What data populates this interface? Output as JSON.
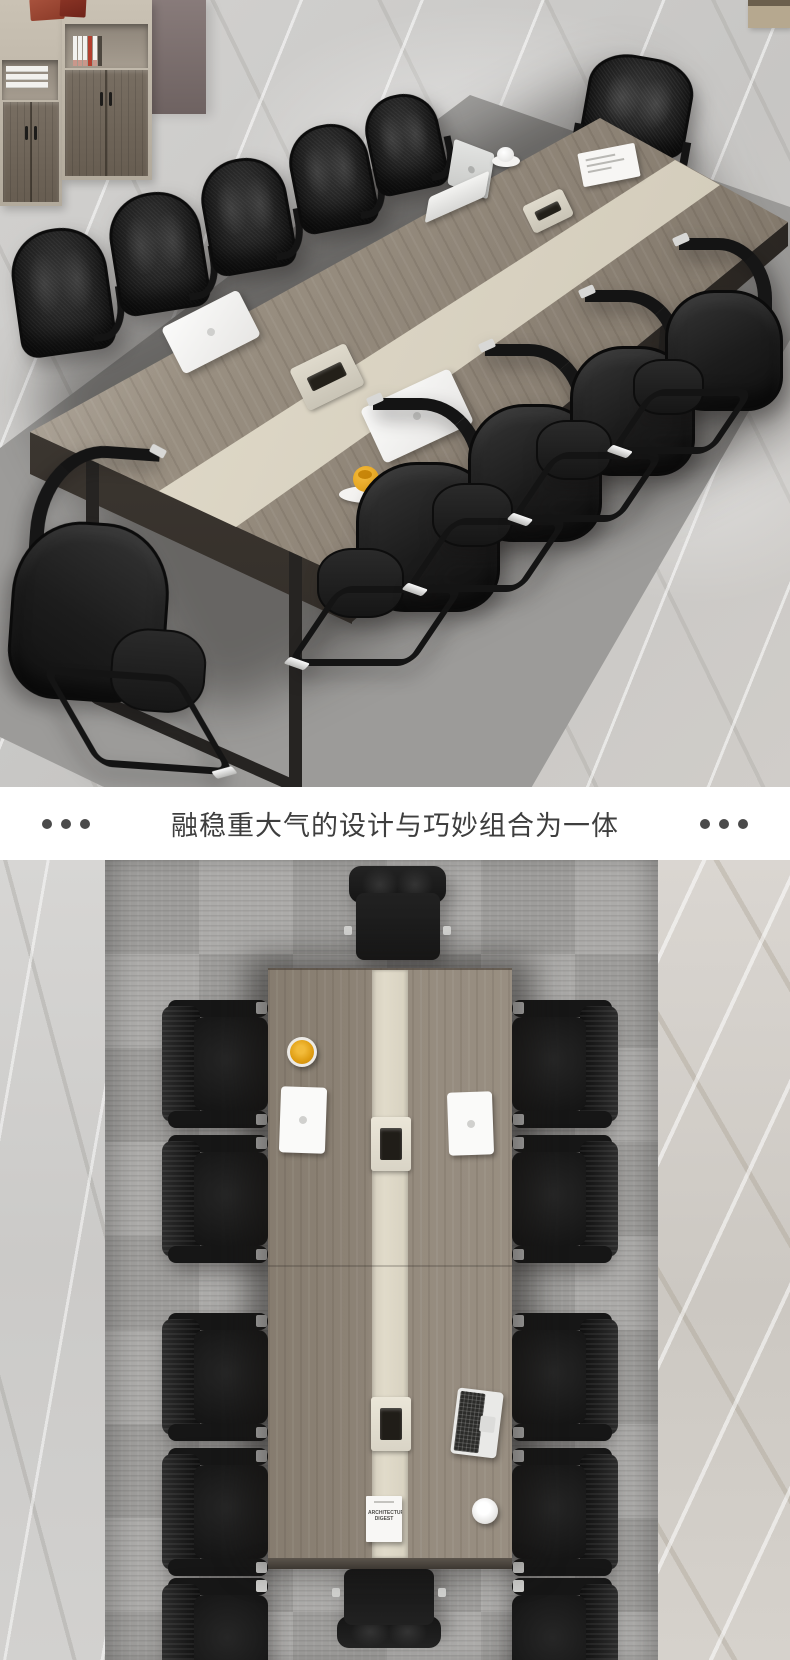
{
  "banner": {
    "title": "融稳重大气的设计与巧妙组合为一体",
    "left_dots": [
      "dot",
      "dot",
      "dot"
    ],
    "right_dots": [
      "dot",
      "dot",
      "dot"
    ],
    "text_color": "#3e3e3e",
    "dot_color": "#4a4a4a",
    "background": "#ffffff"
  },
  "top_photo": {
    "scene": "conference-table-perspective-view",
    "chairs": [
      {
        "type": "far",
        "x": 14,
        "y": 228,
        "w": 96,
        "h": 126,
        "r": -8
      },
      {
        "type": "far",
        "x": 112,
        "y": 192,
        "w": 92,
        "h": 120,
        "r": -9
      },
      {
        "type": "far",
        "x": 204,
        "y": 158,
        "w": 86,
        "h": 114,
        "r": -10
      },
      {
        "type": "far",
        "x": 292,
        "y": 124,
        "w": 80,
        "h": 106,
        "r": -11
      },
      {
        "type": "far",
        "x": 368,
        "y": 94,
        "w": 74,
        "h": 98,
        "r": -12
      },
      {
        "type": "head",
        "x": 582,
        "y": 56,
        "w": 106,
        "h": 132,
        "r": 10
      },
      {
        "type": "near",
        "x": -18,
        "y": 446,
        "w": 238,
        "h": 320,
        "r": -4,
        "flip": true
      },
      {
        "type": "near",
        "x": 308,
        "y": 398,
        "w": 218,
        "h": 268,
        "r": 0
      },
      {
        "type": "near",
        "x": 424,
        "y": 344,
        "w": 202,
        "h": 248,
        "r": 0
      },
      {
        "type": "near",
        "x": 528,
        "y": 290,
        "w": 190,
        "h": 232,
        "r": 0
      },
      {
        "type": "near",
        "x": 626,
        "y": 238,
        "w": 178,
        "h": 216,
        "r": 0
      }
    ]
  },
  "bottom_photo": {
    "scene": "conference-table-top-view",
    "magazine": {
      "title": "ARCHITECTURAL DIGEST"
    },
    "chairs": [
      {
        "type": "side",
        "x": 162,
        "y": 140,
        "w": 106,
        "h": 128
      },
      {
        "type": "side",
        "x": 162,
        "y": 275,
        "w": 106,
        "h": 128
      },
      {
        "type": "side",
        "x": 162,
        "y": 453,
        "w": 106,
        "h": 128
      },
      {
        "type": "side",
        "x": 162,
        "y": 588,
        "w": 106,
        "h": 128
      },
      {
        "type": "side",
        "x": 162,
        "y": 718,
        "w": 106,
        "h": 128
      },
      {
        "type": "side",
        "x": 512,
        "y": 140,
        "w": 106,
        "h": 128,
        "flip": true
      },
      {
        "type": "side",
        "x": 512,
        "y": 275,
        "w": 106,
        "h": 128,
        "flip": true
      },
      {
        "type": "side",
        "x": 512,
        "y": 453,
        "w": 106,
        "h": 128,
        "flip": true
      },
      {
        "type": "side",
        "x": 512,
        "y": 588,
        "w": 106,
        "h": 128,
        "flip": true
      },
      {
        "type": "side",
        "x": 512,
        "y": 718,
        "w": 106,
        "h": 128,
        "flip": true
      },
      {
        "type": "end",
        "x": 345,
        "y": 6,
        "w": 105,
        "h": 104
      },
      {
        "type": "end",
        "x": 333,
        "y": 700,
        "w": 112,
        "h": 88,
        "vflip": true
      }
    ]
  },
  "theme": {
    "marble": "#cdccca",
    "carpet": "#9e9d9b",
    "table_wood": "#8f8578",
    "table_stripe": "#ddd7c6",
    "table_apron": "#453f39",
    "chair_black": "#1c1c1c",
    "chrome": "#d6d6d4",
    "wall_panel": "#7d7170",
    "cabinet_frame": "#c1b9ab",
    "cabinet_door": "#6f6559",
    "storage_box_red": "#a04b38",
    "cup_yellow": "#e8a81e",
    "laptop_white": "#f2f2f0"
  }
}
